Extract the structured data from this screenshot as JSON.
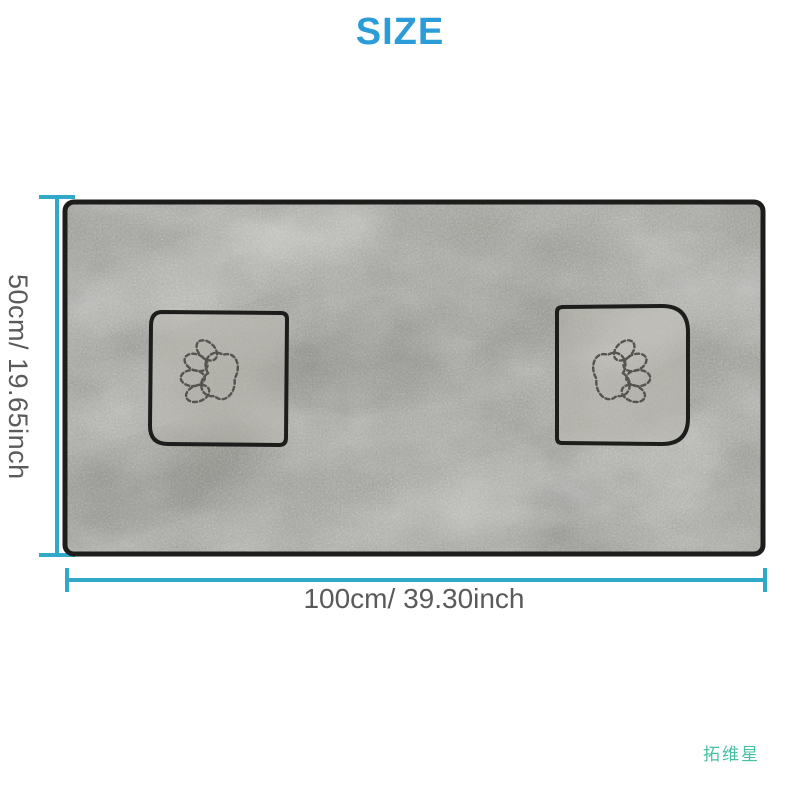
{
  "page": {
    "title": "SIZE"
  },
  "size_diagram": {
    "height_label": "50cm/ 19.65inch",
    "width_label": "100cm/ 39.30inch",
    "towel": {
      "description": "gray microfiber pet drying towel with two hand pockets",
      "pocket_count": 2,
      "pocket_icon": "paw-print-icon"
    }
  },
  "brand_watermark": "拓维星",
  "colors": {
    "title_blue": "#2b9cd7",
    "dimension_cyan": "#2fa9c7",
    "label_gray": "#595a5c",
    "brand_teal": "#46c1a4",
    "towel_gray": "#a1a19a",
    "pocket_gray": "#acaba4",
    "towel_edge": "#1d1d1b",
    "stitch_gray": "#55544e"
  }
}
